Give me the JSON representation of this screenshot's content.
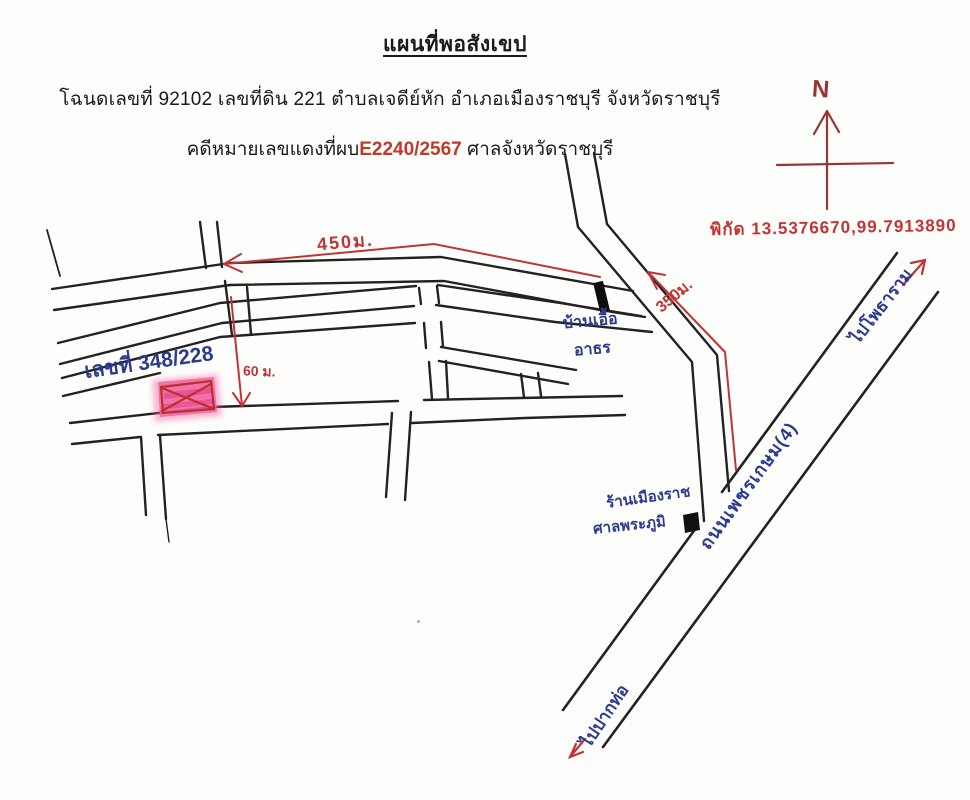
{
  "document": {
    "title": "แผนที่พอสังเขป",
    "deed_line": "โฉนดเลขที่ 92102  เลขที่ดิน 221  ตำบลเจดีย์หัก อำเภอเมืองราชบุรี จังหวัดราชบุรี",
    "case_line_prefix": "คดีหมายเลขแดงที่ผบ",
    "case_number": "E2240/2567",
    "case_line_suffix": " ศาลจังหวัดราชบุรี"
  },
  "compass": {
    "north_label": "N"
  },
  "map": {
    "coordinates_note": "พิกัด 13.5376670,99.7913890",
    "measurements": {
      "main_road_distance": "450ม.",
      "bypass_distance": "350ม.",
      "side_street_distance": "60 ม."
    },
    "labels": {
      "plot_number": "เลขที่ 348/228",
      "housing_line1": "บ้านเอื้อ",
      "housing_line2": "อาธร",
      "shop_line1": "ร้านเมืองราช",
      "shop_line2": "ศาลพระภูมิ",
      "highway_name": "ถนนเพชรเกษม(4)",
      "to_photharam": "ไปโพธาราม",
      "to_paktho": "ไปปากท่อ"
    },
    "colors": {
      "black_ink": "#222222",
      "red_ink": "#c13434",
      "maroon_ink": "#9a3434",
      "blue_ink": "#2b3a8c",
      "typed_red": "#c0392b",
      "plot_pink": "#ef5f9e"
    }
  }
}
